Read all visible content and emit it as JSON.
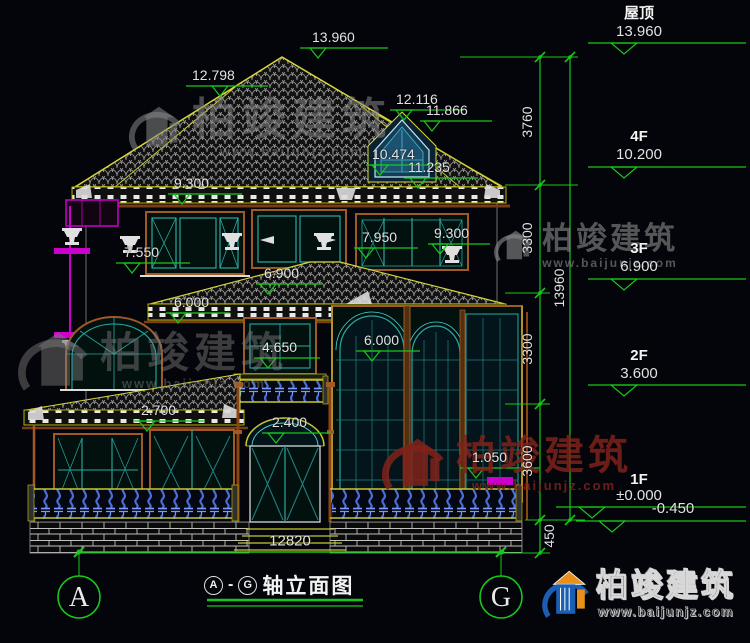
{
  "title": {
    "axis_from": "A",
    "axis_to": "G",
    "separator": "-",
    "text": "轴立面图"
  },
  "axes": {
    "left": "A",
    "right": "G"
  },
  "bottom_dim": "12820",
  "floor_levels": [
    {
      "label": "屋顶",
      "value": "13.960"
    },
    {
      "label": "4F",
      "value": "10.200"
    },
    {
      "label": "3F",
      "value": "6.900"
    },
    {
      "label": "2F",
      "value": "3.600"
    },
    {
      "label": "1F",
      "value": "±0.000"
    },
    {
      "label": "",
      "value": "-0.450"
    }
  ],
  "vertical_dims": {
    "segments": [
      "3760",
      "3300",
      "3300",
      "3600",
      "450"
    ],
    "total": "13960"
  },
  "elevation_marks": [
    "13.960",
    "12.798",
    "12.116",
    "11.866",
    "10.474",
    "11.235",
    "9.300",
    "9.300",
    "7.950",
    "7.550",
    "6.900",
    "6.000",
    "4.650",
    "6.000",
    "2.700",
    "2.400",
    "1.050"
  ],
  "watermark": {
    "text": "柏竣建筑",
    "url": "www.baijunjz.com"
  },
  "logo": {
    "text": "柏竣建筑",
    "url": "www.baijunjz.com"
  },
  "colors": {
    "background": "#04050a",
    "dimension_green": "#18c818",
    "roof_outline": "#d8d83a",
    "frame_brown": "#a05a28",
    "mullion_teal": "#2aa8a0",
    "accent_cyan": "#49d8d8",
    "accent_magenta": "#cc00cc",
    "baluster_blue": "#4a6fd8",
    "dim_text": "#e2e2e2",
    "watermark_gray": "#878787",
    "watermark_red": "#80221a",
    "logo_blue": "#1a5fb4",
    "logo_orange": "#e8901a"
  }
}
